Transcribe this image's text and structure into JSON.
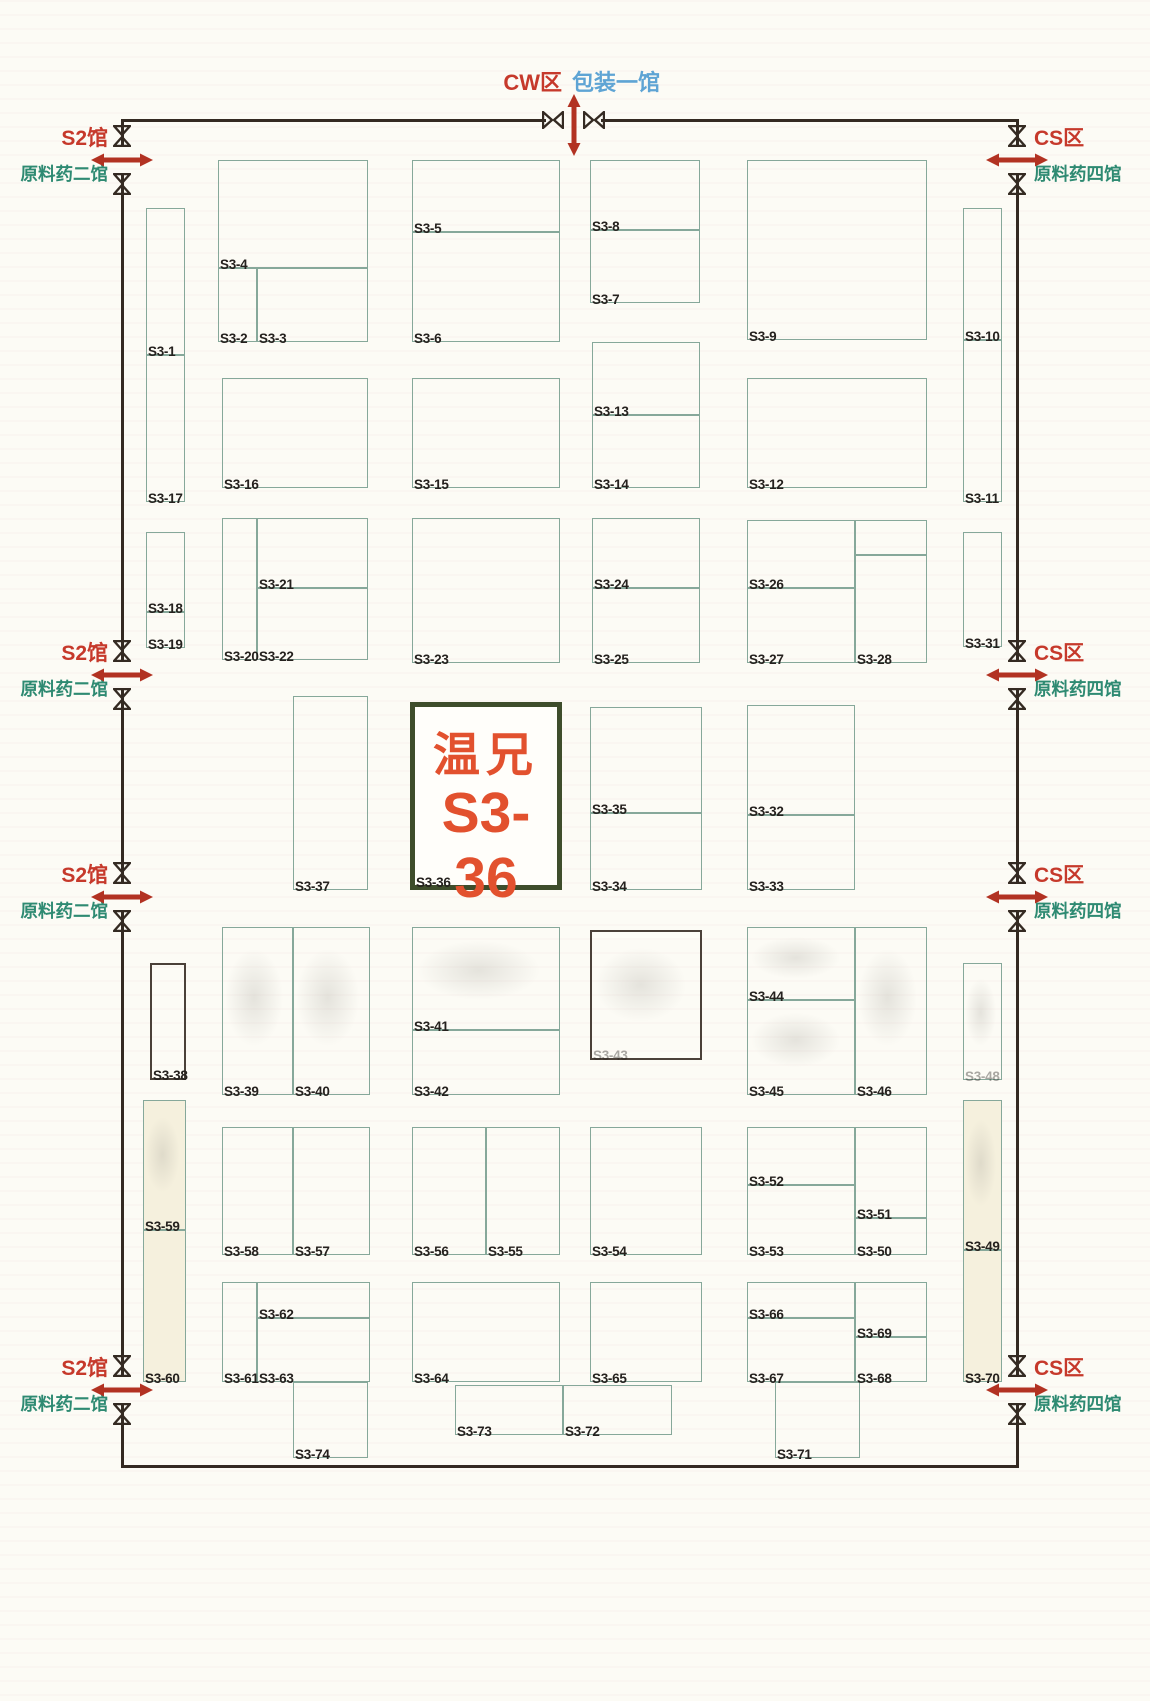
{
  "title": "展馆平面图 S3区",
  "highlight": {
    "company": "温兄",
    "code": "S3-36"
  },
  "entrances": {
    "top": {
      "zone_label": "CW区",
      "hall_label": "包装一馆",
      "x": 574
    },
    "left": {
      "zone_label": "S2馆",
      "hall_label": "原料药二馆",
      "positions_y": [
        160,
        675,
        897,
        1390
      ]
    },
    "right": {
      "zone_label": "CS区",
      "hall_label": "原料药四馆",
      "positions_y": [
        160,
        675,
        897,
        1390
      ]
    }
  },
  "colors": {
    "booth_line": "#86a89a",
    "dark_line": "#4a4038",
    "wall": "#342a22",
    "zone_red": "#c6392b",
    "hall_green": "#2e8a72",
    "hall_blue": "#5ea4d4",
    "arrow_red": "#b23222",
    "highlight_border": "#3e4d2b",
    "highlight_text": "#e2512e",
    "label": "#25211e"
  },
  "booths": [
    {
      "label": "S3-1",
      "x": 146,
      "y": 208,
      "w": 39,
      "h": 147
    },
    {
      "label": "S3-17",
      "x": 146,
      "y": 355,
      "w": 39,
      "h": 147
    },
    {
      "label": "S3-18",
      "x": 146,
      "y": 532,
      "w": 39,
      "h": 80
    },
    {
      "label": "S3-19",
      "x": 146,
      "y": 612,
      "w": 39,
      "h": 36
    },
    {
      "label": "S3-4",
      "x": 218,
      "y": 160,
      "w": 150,
      "h": 108
    },
    {
      "label": "S3-2",
      "x": 218,
      "y": 268,
      "w": 39,
      "h": 74
    },
    {
      "label": "S3-3",
      "x": 257,
      "y": 268,
      "w": 111,
      "h": 74
    },
    {
      "label": "S3-5",
      "x": 412,
      "y": 160,
      "w": 148,
      "h": 72
    },
    {
      "label": "S3-6",
      "x": 412,
      "y": 232,
      "w": 148,
      "h": 110
    },
    {
      "label": "S3-8",
      "x": 590,
      "y": 160,
      "w": 110,
      "h": 70
    },
    {
      "label": "S3-7",
      "x": 590,
      "y": 230,
      "w": 110,
      "h": 73
    },
    {
      "label": "S3-9",
      "x": 747,
      "y": 160,
      "w": 180,
      "h": 180
    },
    {
      "label": "S3-10",
      "x": 963,
      "y": 208,
      "w": 39,
      "h": 132
    },
    {
      "label": "S3-11",
      "x": 963,
      "y": 340,
      "w": 39,
      "h": 162
    },
    {
      "label": "S3-16",
      "x": 222,
      "y": 378,
      "w": 146,
      "h": 110
    },
    {
      "label": "S3-15",
      "x": 412,
      "y": 378,
      "w": 148,
      "h": 110
    },
    {
      "label": "S3-13",
      "x": 592,
      "y": 342,
      "w": 108,
      "h": 73
    },
    {
      "label": "S3-14",
      "x": 592,
      "y": 415,
      "w": 108,
      "h": 73
    },
    {
      "label": "S3-12",
      "x": 747,
      "y": 378,
      "w": 180,
      "h": 110
    },
    {
      "label": "S3-20",
      "x": 222,
      "y": 518,
      "w": 35,
      "h": 142
    },
    {
      "label": "S3-21",
      "x": 257,
      "y": 518,
      "w": 111,
      "h": 70
    },
    {
      "label": "S3-22",
      "x": 257,
      "y": 588,
      "w": 111,
      "h": 72
    },
    {
      "label": "S3-23",
      "x": 412,
      "y": 518,
      "w": 148,
      "h": 145
    },
    {
      "label": "S3-24",
      "x": 592,
      "y": 518,
      "w": 108,
      "h": 70
    },
    {
      "label": "S3-25",
      "x": 592,
      "y": 588,
      "w": 108,
      "h": 75
    },
    {
      "label": "S3-26",
      "x": 747,
      "y": 520,
      "w": 108,
      "h": 68
    },
    {
      "label": "S3-27",
      "x": 747,
      "y": 588,
      "w": 108,
      "h": 75
    },
    {
      "label": "",
      "x": 855,
      "y": 520,
      "w": 72,
      "h": 35
    },
    {
      "label": "S3-28",
      "x": 855,
      "y": 555,
      "w": 72,
      "h": 108
    },
    {
      "label": "S3-31",
      "x": 963,
      "y": 532,
      "w": 39,
      "h": 115
    },
    {
      "label": "S3-37",
      "x": 293,
      "y": 696,
      "w": 75,
      "h": 194
    },
    {
      "label": "S3-36",
      "x": 410,
      "y": 702,
      "w": 152,
      "h": 188,
      "highlight": true
    },
    {
      "label": "S3-35",
      "x": 590,
      "y": 707,
      "w": 112,
      "h": 106
    },
    {
      "label": "S3-34",
      "x": 590,
      "y": 813,
      "w": 112,
      "h": 77
    },
    {
      "label": "S3-32",
      "x": 747,
      "y": 705,
      "w": 108,
      "h": 110
    },
    {
      "label": "S3-33",
      "x": 747,
      "y": 815,
      "w": 108,
      "h": 75
    },
    {
      "label": "S3-38",
      "x": 150,
      "y": 963,
      "w": 36,
      "h": 117,
      "stroke": "dark"
    },
    {
      "label": "S3-39",
      "x": 222,
      "y": 927,
      "w": 71,
      "h": 168,
      "ghost": true
    },
    {
      "label": "S3-40",
      "x": 293,
      "y": 927,
      "w": 77,
      "h": 168,
      "ghost": true
    },
    {
      "label": "S3-41",
      "x": 412,
      "y": 927,
      "w": 148,
      "h": 103,
      "ghost": true
    },
    {
      "label": "S3-42",
      "x": 412,
      "y": 1030,
      "w": 148,
      "h": 65
    },
    {
      "label": "S3-43",
      "x": 590,
      "y": 930,
      "w": 112,
      "h": 130,
      "stroke": "dark",
      "faded": true,
      "ghost": true
    },
    {
      "label": "S3-44",
      "x": 747,
      "y": 927,
      "w": 108,
      "h": 73,
      "ghost": true
    },
    {
      "label": "S3-45",
      "x": 747,
      "y": 1000,
      "w": 108,
      "h": 95,
      "ghost": true
    },
    {
      "label": "S3-46",
      "x": 855,
      "y": 927,
      "w": 72,
      "h": 168,
      "ghost": true
    },
    {
      "label": "S3-48",
      "x": 963,
      "y": 963,
      "w": 39,
      "h": 117,
      "faded": true,
      "ghost": true
    },
    {
      "label": "S3-59",
      "x": 143,
      "y": 1100,
      "w": 43,
      "h": 130,
      "tint": true,
      "ghost": true
    },
    {
      "label": "S3-60",
      "x": 143,
      "y": 1230,
      "w": 43,
      "h": 152,
      "tint": true
    },
    {
      "label": "S3-58",
      "x": 222,
      "y": 1127,
      "w": 71,
      "h": 128
    },
    {
      "label": "S3-57",
      "x": 293,
      "y": 1127,
      "w": 77,
      "h": 128
    },
    {
      "label": "S3-56",
      "x": 412,
      "y": 1127,
      "w": 74,
      "h": 128
    },
    {
      "label": "S3-55",
      "x": 486,
      "y": 1127,
      "w": 74,
      "h": 128
    },
    {
      "label": "S3-54",
      "x": 590,
      "y": 1127,
      "w": 112,
      "h": 128
    },
    {
      "label": "S3-52",
      "x": 747,
      "y": 1127,
      "w": 108,
      "h": 58
    },
    {
      "label": "S3-53",
      "x": 747,
      "y": 1185,
      "w": 108,
      "h": 70
    },
    {
      "label": "S3-51",
      "x": 855,
      "y": 1127,
      "w": 72,
      "h": 91
    },
    {
      "label": "S3-50",
      "x": 855,
      "y": 1218,
      "w": 72,
      "h": 37
    },
    {
      "label": "S3-49",
      "x": 963,
      "y": 1100,
      "w": 39,
      "h": 150,
      "tint": true,
      "ghost": true
    },
    {
      "label": "S3-70",
      "x": 963,
      "y": 1250,
      "w": 39,
      "h": 132,
      "tint": true
    },
    {
      "label": "S3-61",
      "x": 222,
      "y": 1282,
      "w": 35,
      "h": 100
    },
    {
      "label": "S3-62",
      "x": 257,
      "y": 1282,
      "w": 113,
      "h": 36
    },
    {
      "label": "S3-63",
      "x": 257,
      "y": 1318,
      "w": 113,
      "h": 64
    },
    {
      "label": "S3-64",
      "x": 412,
      "y": 1282,
      "w": 148,
      "h": 100
    },
    {
      "label": "S3-65",
      "x": 590,
      "y": 1282,
      "w": 112,
      "h": 100
    },
    {
      "label": "S3-66",
      "x": 747,
      "y": 1282,
      "w": 108,
      "h": 36
    },
    {
      "label": "S3-67",
      "x": 747,
      "y": 1318,
      "w": 108,
      "h": 64
    },
    {
      "label": "S3-69",
      "x": 855,
      "y": 1282,
      "w": 72,
      "h": 55
    },
    {
      "label": "S3-68",
      "x": 855,
      "y": 1337,
      "w": 72,
      "h": 45
    },
    {
      "label": "S3-74",
      "x": 293,
      "y": 1382,
      "w": 75,
      "h": 76
    },
    {
      "label": "S3-73",
      "x": 455,
      "y": 1385,
      "w": 108,
      "h": 50
    },
    {
      "label": "S3-72",
      "x": 563,
      "y": 1385,
      "w": 109,
      "h": 50
    },
    {
      "label": "S3-71",
      "x": 775,
      "y": 1382,
      "w": 85,
      "h": 76
    }
  ],
  "walls": {
    "left_x": 122,
    "right_x": 1017,
    "top_y": 120,
    "bottom_y": 1466,
    "top_gap": [
      546,
      601
    ],
    "side_gap_halfwidth": 13
  }
}
